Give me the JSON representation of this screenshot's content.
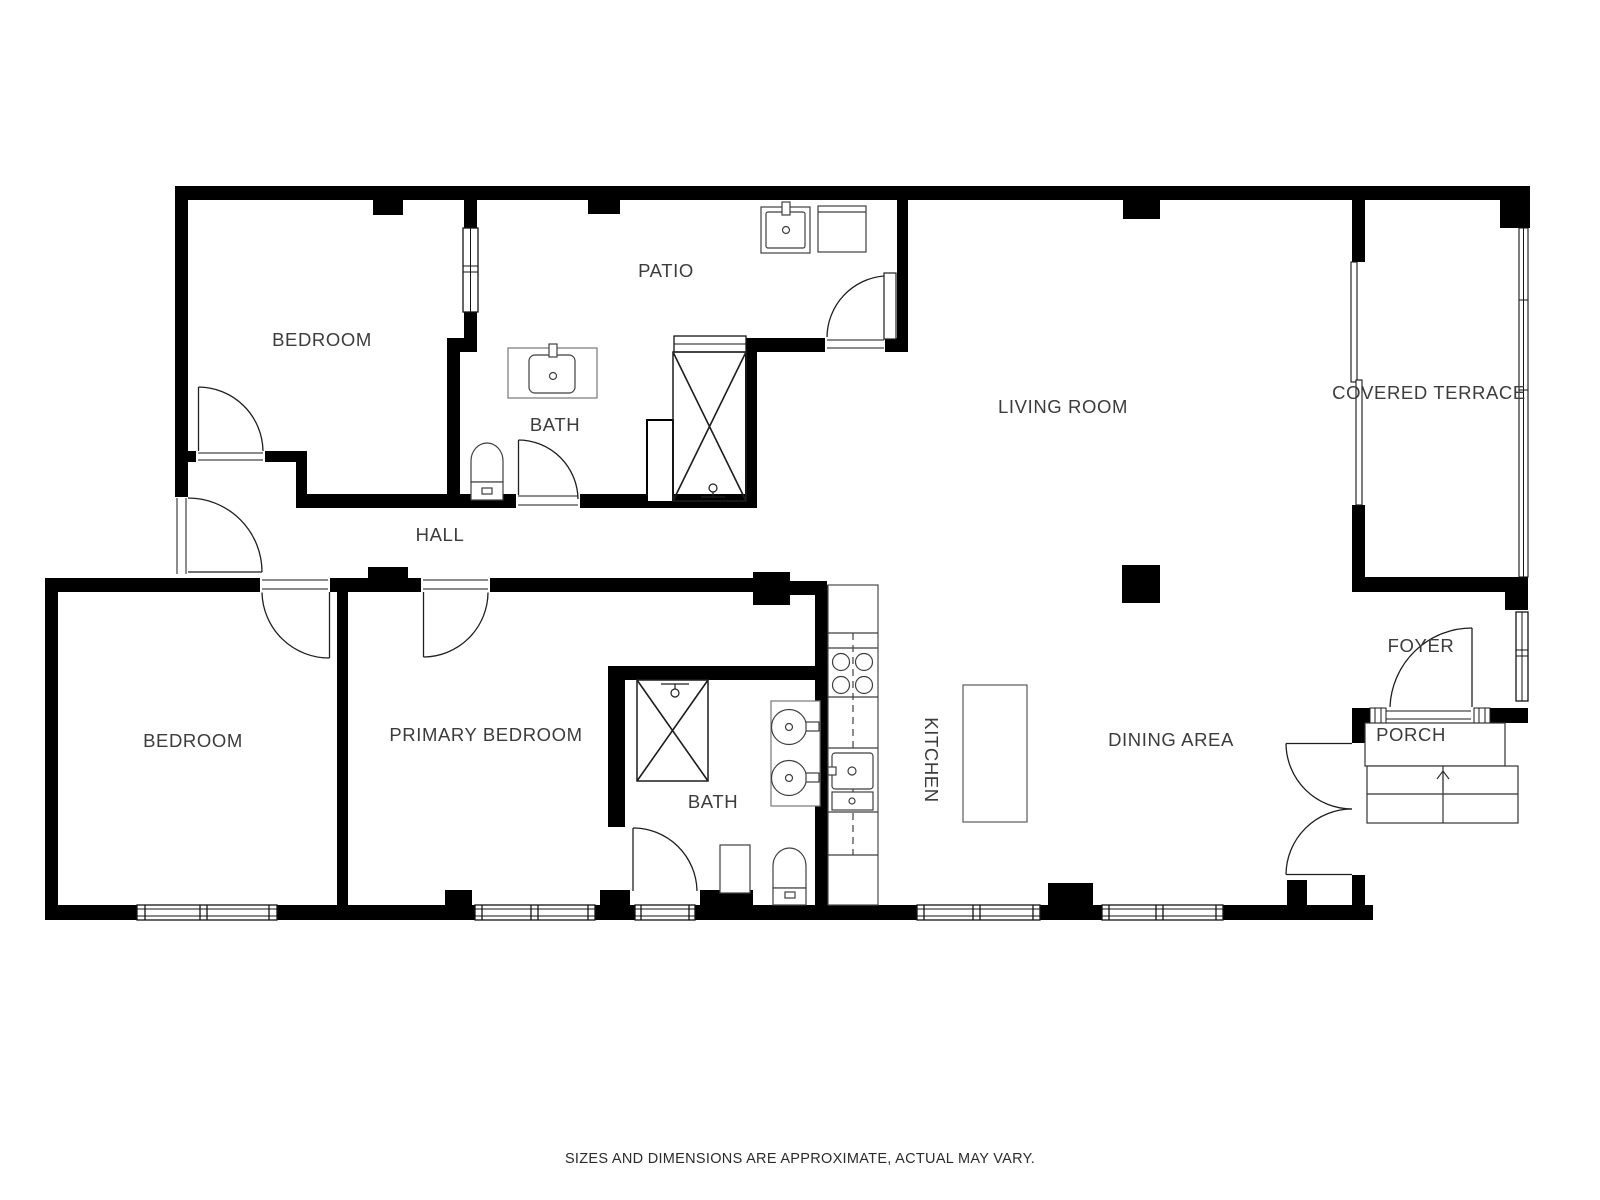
{
  "colors": {
    "wall": "#000000",
    "background": "#ffffff",
    "label": "#3c3c3c",
    "fixture": "#3f3f3f"
  },
  "rooms": {
    "bedroom_top": {
      "label": "BEDROOM"
    },
    "patio": {
      "label": "PATIO"
    },
    "bath_top": {
      "label": "BATH"
    },
    "hall": {
      "label": "HALL"
    },
    "living_room": {
      "label": "LIVING ROOM"
    },
    "covered_terrace": {
      "label": "COVERED TERRACE"
    },
    "foyer": {
      "label": "FOYER"
    },
    "porch": {
      "label": "PORCH"
    },
    "kitchen": {
      "label": "KITCHEN"
    },
    "dining_area": {
      "label": "DINING AREA"
    },
    "bedroom_left": {
      "label": "BEDROOM"
    },
    "primary_bedroom": {
      "label": "PRIMARY BEDROOM"
    },
    "bath_bottom": {
      "label": "BATH"
    }
  },
  "footer": {
    "disclaimer": "SIZES AND DIMENSIONS ARE APPROXIMATE, ACTUAL MAY VARY."
  }
}
